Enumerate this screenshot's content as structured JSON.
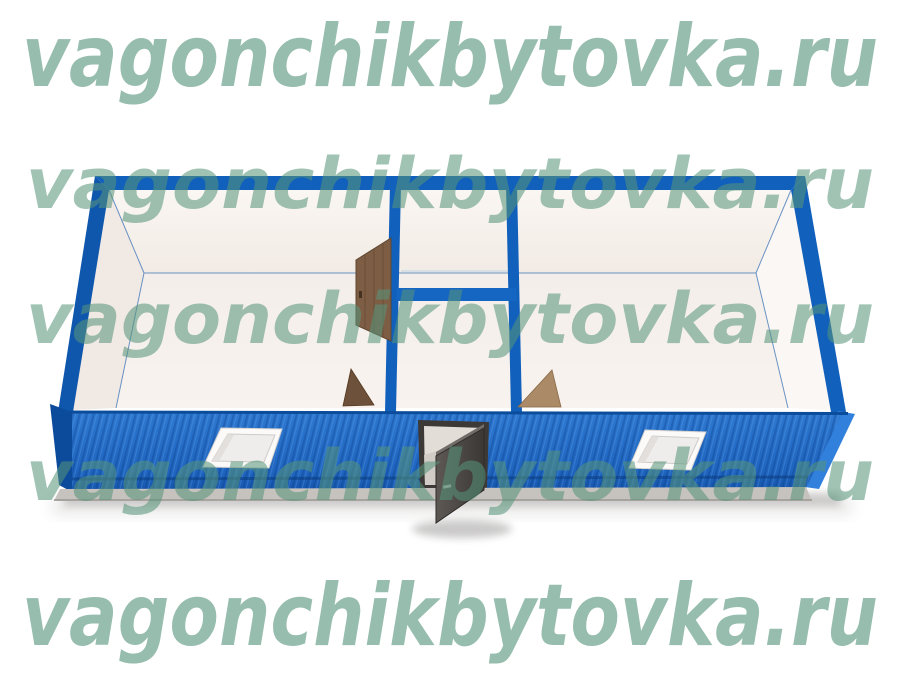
{
  "watermark": {
    "text": "vagonchikbytovka.ru"
  },
  "colors": {
    "frame_blue": "#1160bc",
    "wall_blue_light": "#2e79d2",
    "wall_blue_dark": "#1757ae",
    "end_cap_dark_blue": "#0c4b9c",
    "end_cap_light_blue": "#3180dc",
    "watermark_green_large": "rgba(86,148,122,0.62)",
    "watermark_green_small": "rgba(86,148,122,0.56)",
    "interior_white": "#f9f4f0",
    "floor_white": "#f5efeb",
    "wood_brown": "#7d5e44",
    "wood_brown_dark": "#6e513b",
    "wood_brown_light": "#ab8b67",
    "entry_door_gray": "#4b4744",
    "base_gray": "#c6c2be",
    "window_white": "#fbfaf9"
  }
}
